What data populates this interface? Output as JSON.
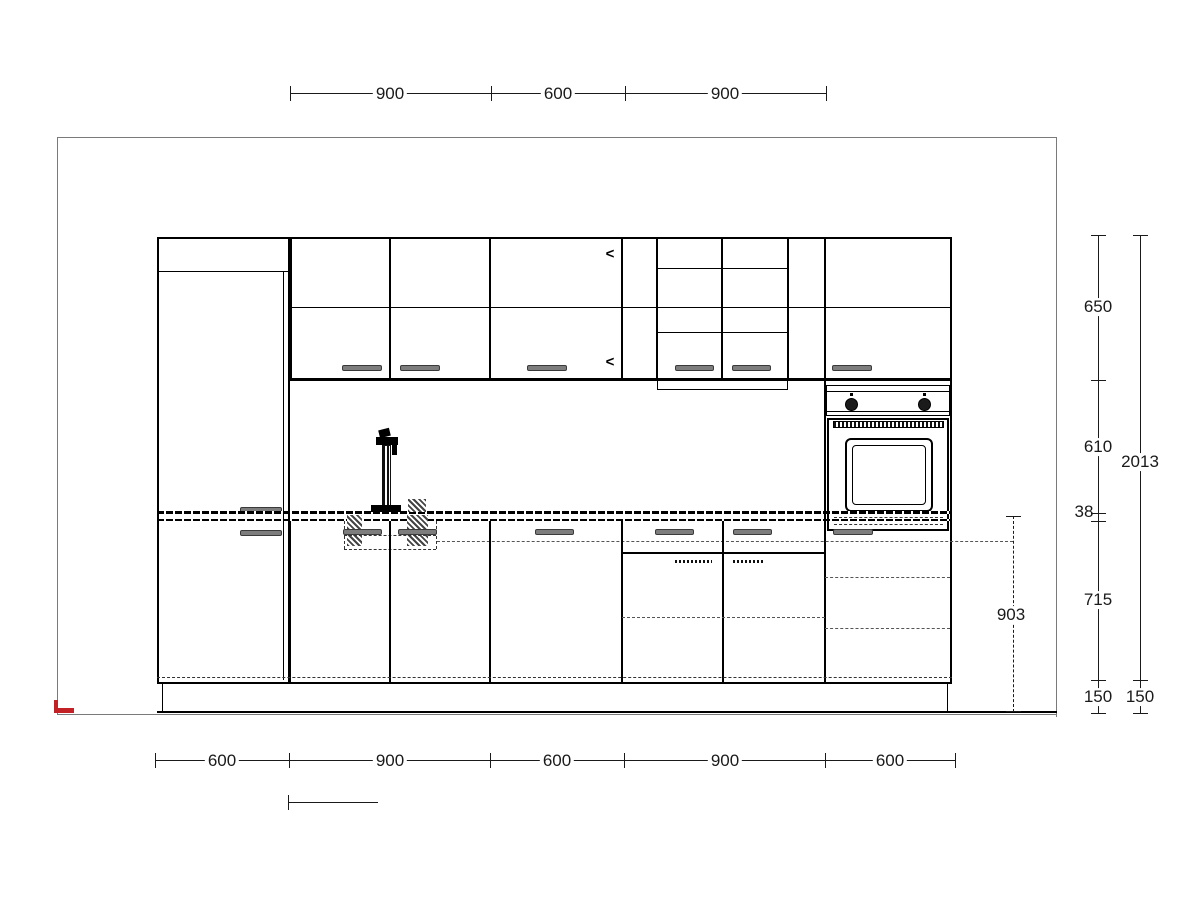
{
  "dimensions": {
    "top": [
      "900",
      "600",
      "900"
    ],
    "bottom": [
      "600",
      "900",
      "600",
      "900",
      "600"
    ],
    "right_inner": [
      "650",
      "610",
      "38",
      "715",
      "150"
    ],
    "right_outer": [
      "2013",
      "150"
    ],
    "worktop_height": "903"
  },
  "icons": {
    "door_swing": "<"
  },
  "colors": {
    "cabinet_line": "#000000",
    "dimension_line": "#1a1a1a",
    "room_outline": "#7a7a7a",
    "handle": "#7d7d7d",
    "corner_marker_red": "#c22126"
  }
}
